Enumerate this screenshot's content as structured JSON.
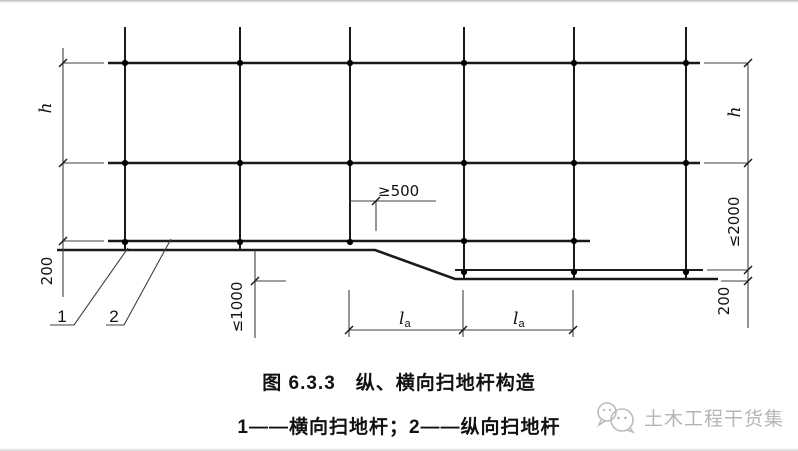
{
  "figure": {
    "caption": "图 6.3.3　纵、横向扫地杆构造",
    "legend": "1——横向扫地杆；2——纵向扫地杆"
  },
  "labels": {
    "h_left": "h",
    "h_right": "h",
    "dim200_left": "200",
    "dim200_right": "200",
    "ge500": "≥500",
    "le1000": "≤1000",
    "le2000": "≤2000",
    "la_main": "l",
    "la_sub": "a",
    "leader1": "1",
    "leader2": "2"
  },
  "watermark": {
    "text": "土木工程干货集"
  },
  "colors": {
    "line": "#1a1a1a",
    "dim": "#3f3f3f",
    "watermark": "#b5b5b5"
  }
}
